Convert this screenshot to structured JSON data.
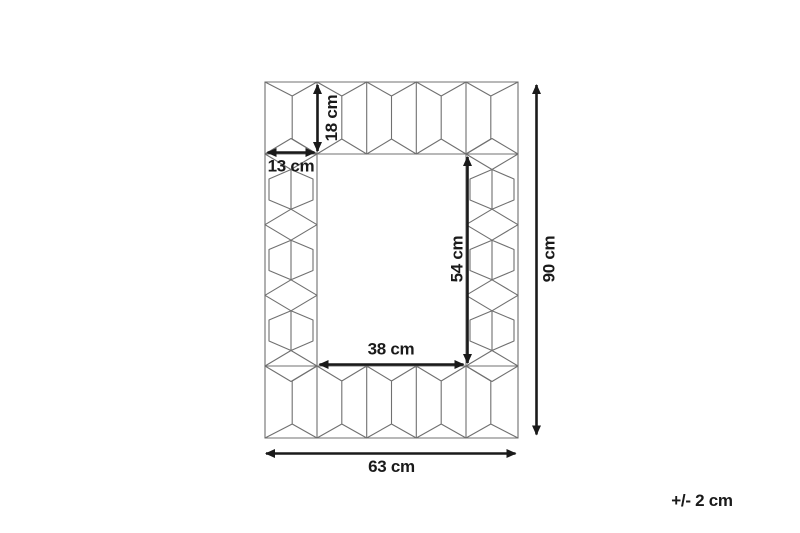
{
  "title": "Mirror dimension diagram",
  "tolerance_note": "+/- 2 cm",
  "dimensions": [
    {
      "id": "frame-height-top",
      "label": "18 cm",
      "value_cm": 18,
      "measures": "frame band height (top)",
      "orientation": "vertical"
    },
    {
      "id": "frame-width-side",
      "label": "13 cm",
      "value_cm": 13,
      "measures": "frame band width (side)",
      "orientation": "horizontal"
    },
    {
      "id": "inner-height",
      "label": "54 cm",
      "value_cm": 54,
      "measures": "inner opening height",
      "orientation": "vertical"
    },
    {
      "id": "inner-width",
      "label": "38 cm",
      "value_cm": 38,
      "measures": "inner opening width",
      "orientation": "horizontal"
    },
    {
      "id": "outer-height",
      "label": "90 cm",
      "value_cm": 90,
      "measures": "overall height",
      "orientation": "vertical"
    },
    {
      "id": "outer-width",
      "label": "63 cm",
      "value_cm": 63,
      "measures": "overall width",
      "orientation": "horizontal"
    }
  ],
  "colors": {
    "background": "#ffffff",
    "frame_line": "#707070",
    "dimension_line": "#1a1a1a",
    "text": "#1a1a1a"
  }
}
